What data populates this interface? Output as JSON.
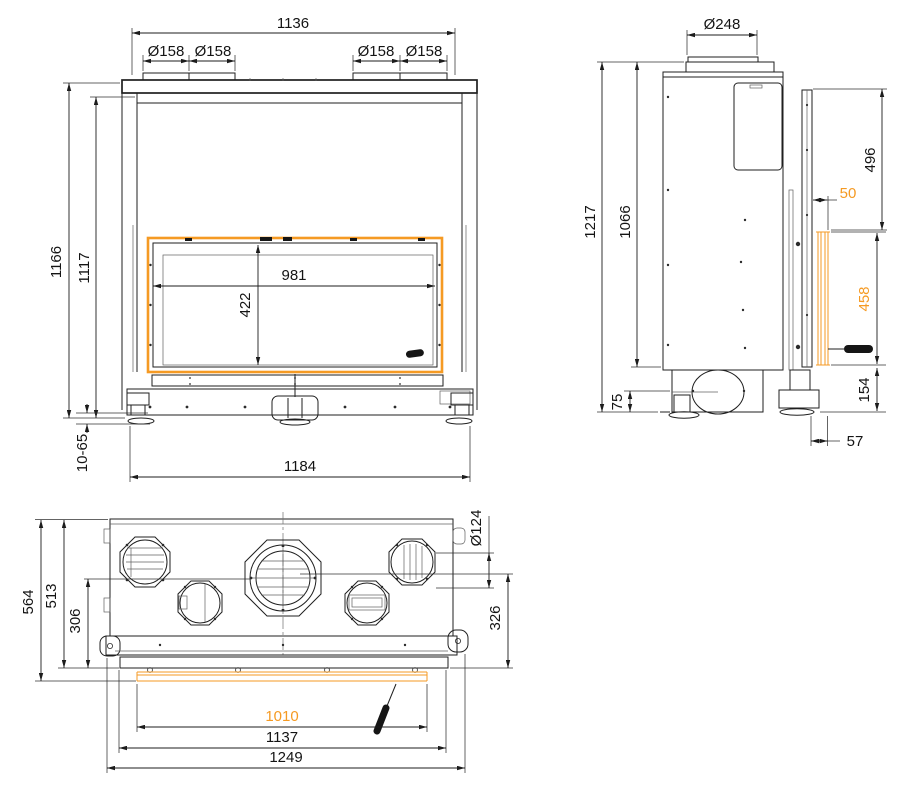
{
  "colors": {
    "accent": "#F59A23",
    "line": "#1C1C1C"
  },
  "views": {
    "front": {
      "top_width": "1136",
      "collar_dia_a": "Ø158",
      "collar_dia_b": "Ø158",
      "collar_dia_c": "Ø158",
      "collar_dia_d": "Ø158",
      "overall_height": "1166",
      "body_height": "1117",
      "glass_width": "981",
      "glass_height": "422",
      "leveling_range": "10-65",
      "base_width": "1184"
    },
    "side": {
      "flue_dia": "Ø248",
      "overall_height": "1217",
      "body_height": "1066",
      "top_section": "496",
      "door_offset": "50",
      "door_height": "458",
      "bottom_section": "154",
      "base_height": "75",
      "handle_clearance": "57"
    },
    "top": {
      "overall_depth": "564",
      "body_depth": "513",
      "vent_axis_depth": "306",
      "vent_dia": "Ø124",
      "front_depth": "326",
      "door_width": "1010",
      "frame_width": "1137",
      "overall_width": "1249"
    }
  }
}
